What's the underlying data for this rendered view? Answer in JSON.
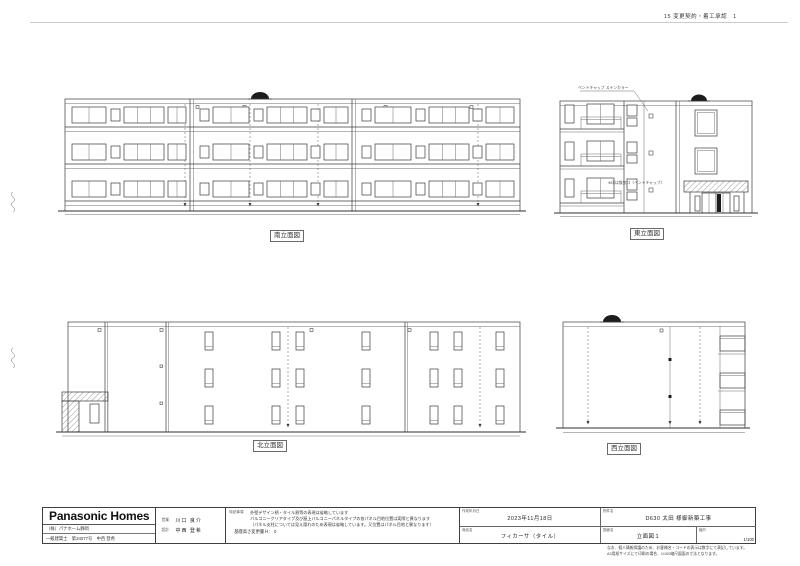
{
  "header": {
    "approval_text": "15 変更契約・着工承認　1"
  },
  "elevations": {
    "south_label": "南立面図",
    "east_label": "東立面図",
    "north_label": "北立面図",
    "west_label": "西立面図",
    "east_annotation_top": "ベントキャップ ステンカラー",
    "east_annotation_mid": "※印は換気口（ベントキャップ）"
  },
  "title_block": {
    "logo_text": "Panasonic Homes",
    "company": "（株）パナホーム静岡",
    "license": "一級建築士　第34077号　中西 登希",
    "staff": {
      "sales_label": "営業",
      "sales_name": "川口 良介",
      "design_label": "設計",
      "design_name": "中西 登希"
    },
    "notes_label": "特記事項",
    "note1": "外壁デザイン柄・タイル割等の表現は省略しています",
    "note2": "バルコニークリアタイプ及び屋上バルコニーパネルタイプの各パネル目地位置は実際と異なります",
    "note3": "（パネル支柱については見え隠れのため表現は省略しています。又位置はパネル目地と異なります）",
    "base_note": "基礎高さ変更量Ｈ： 0",
    "date_label": "作成年月日",
    "date_value": "2023年11月18日",
    "product_label": "商品名",
    "product_value": "フィカーサ（タイル）",
    "project_label": "物件名",
    "project_value": "D630 太田 様御新築工事",
    "drawing_label": "図面名",
    "drawing_value": "立面図１",
    "scale_label": "縮尺",
    "scale_value": "1/100",
    "fine_print1": "なお、個人情報保護のため、お客様名・コードの表示は数字にて表記しています。",
    "fine_print2": "A3用紙サイズにて印刷の場合、1/100縮尺図面の寸法となります。"
  }
}
